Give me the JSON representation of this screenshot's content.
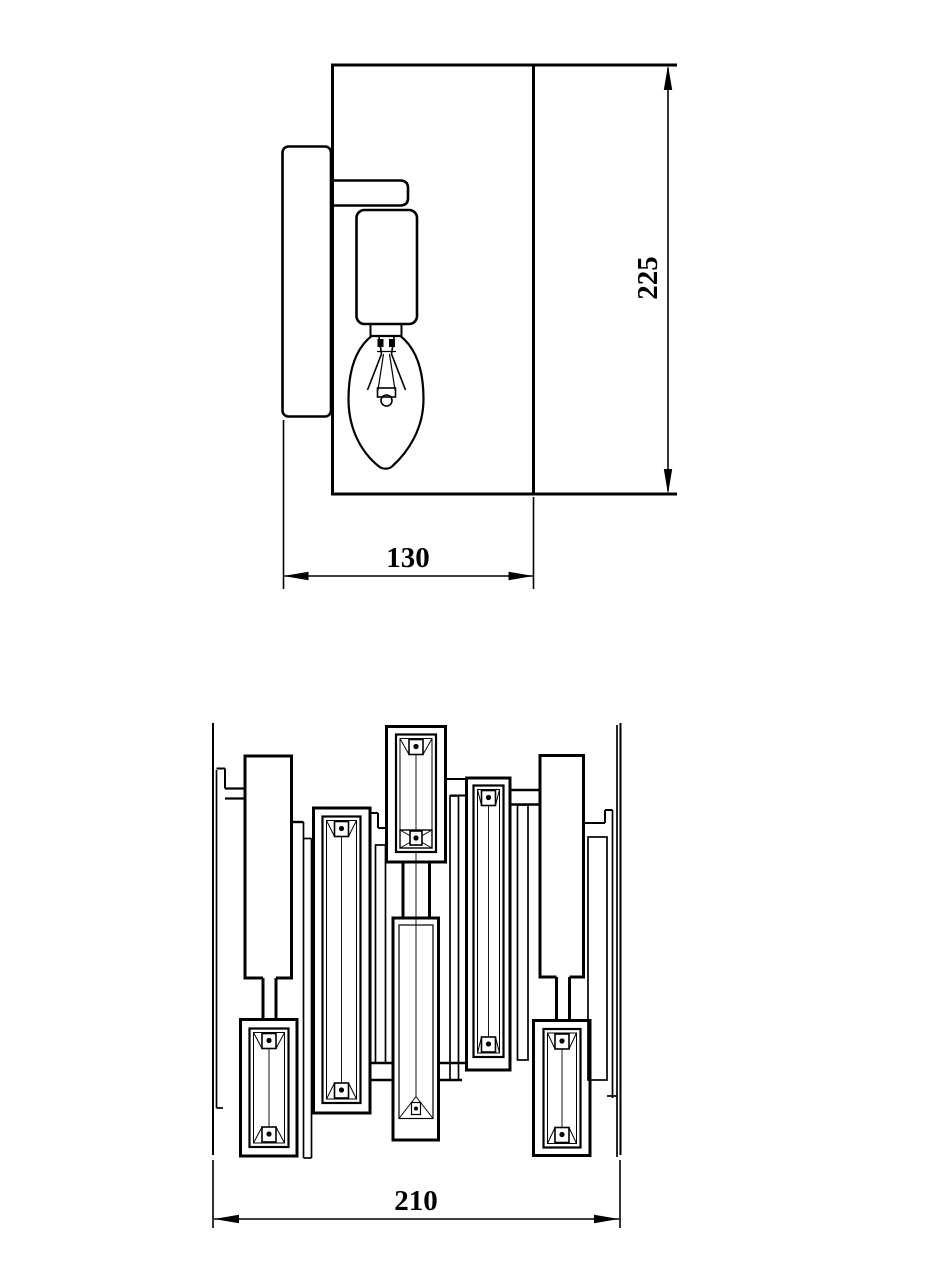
{
  "document": {
    "background": "#ffffff",
    "line_color": "#000000",
    "kind": "technical drawing of crystal wall sconce"
  },
  "side_view": {
    "label": "side elevation with bulb",
    "dim_height": "225",
    "dim_depth": "130"
  },
  "front_view": {
    "label": "front elevation of crystal panel",
    "dim_width": "210",
    "crystals": [
      {
        "name": "crystal-bottom-left",
        "type": "standard",
        "cx": 269,
        "hw": 19.5,
        "top": 1028.5,
        "bottom": 1147
      },
      {
        "name": "crystal-left-middle",
        "type": "standard",
        "cx": 341.5,
        "hw": 19,
        "top": 816.5,
        "bottom": 1103
      },
      {
        "name": "crystal-top-center",
        "type": "xbox",
        "cx": 416,
        "hw": 20,
        "top": 734.5,
        "bottom": 852
      },
      {
        "name": "crystal-right-middle",
        "type": "standard",
        "cx": 488.5,
        "hw": 15,
        "top": 785.5,
        "bottom": 1057
      },
      {
        "name": "crystal-bottom-right",
        "type": "standard",
        "cx": 562,
        "hw": 18.5,
        "top": 1029,
        "bottom": 1147.5
      },
      {
        "name": "crystal-center-long",
        "type": "apex",
        "cx": 416,
        "hw": 17,
        "top": 925,
        "bottom": 1118.5,
        "cl_top": 852
      }
    ]
  }
}
